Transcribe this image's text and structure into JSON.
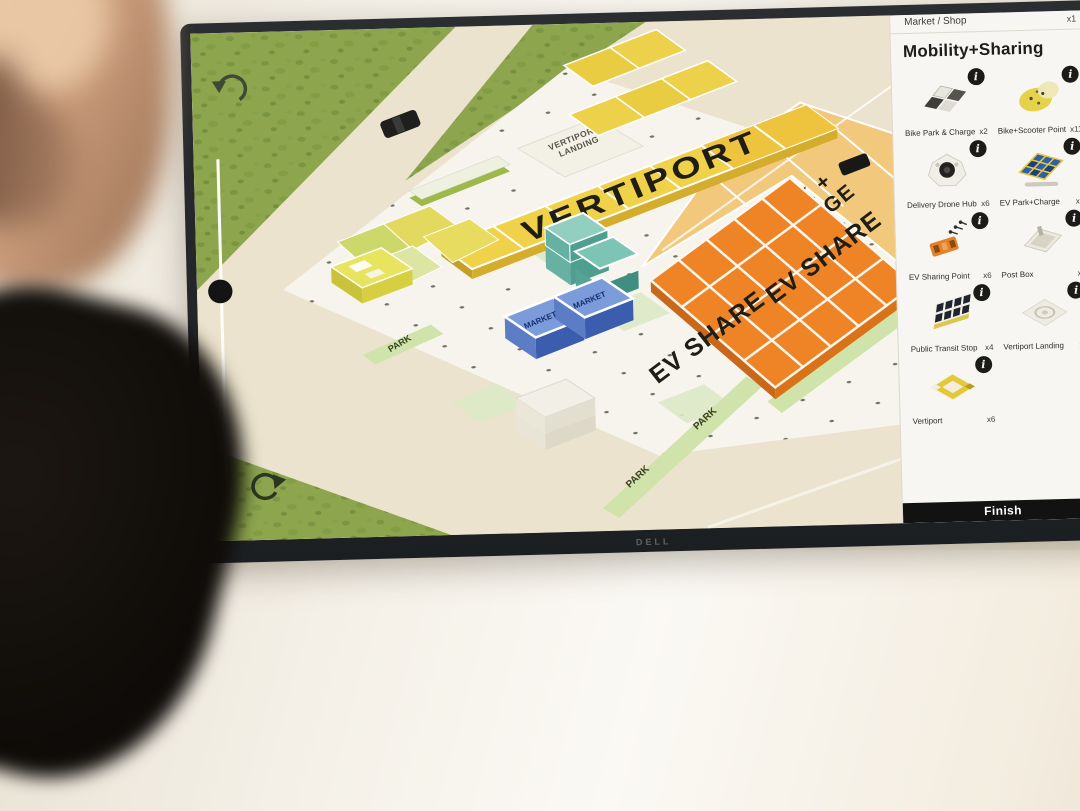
{
  "monitor": {
    "brand": "DELL"
  },
  "map": {
    "labels": {
      "vertiport": "VERTIPORT",
      "vertiport_landing_line1": "VERTIPORT",
      "vertiport_landing_line2": "LANDING",
      "park_charge_line1": "PARK +",
      "park_charge_line2": "CHARGE",
      "ev_share": "EV SHARE",
      "market": "MARKET",
      "park": "PARK"
    }
  },
  "sidebar": {
    "previous_item": {
      "label": "Market / Shop",
      "count": "x1"
    },
    "title": "Mobility+Sharing",
    "info_badge": "i",
    "items": [
      {
        "label": "Bike Park & Charge",
        "count": "x2",
        "icon": "bike-park-charge-icon"
      },
      {
        "label": "Bike+Scooter Point",
        "count": "x11",
        "icon": "bike-scooter-point-icon"
      },
      {
        "label": "Delivery Drone Hub",
        "count": "x6",
        "icon": "delivery-drone-hub-icon"
      },
      {
        "label": "EV Park+Charge",
        "count": "x5",
        "icon": "ev-park-charge-icon"
      },
      {
        "label": "EV Sharing Point",
        "count": "x6",
        "icon": "ev-sharing-point-icon"
      },
      {
        "label": "Post Box",
        "count": "x2",
        "icon": "post-box-icon"
      },
      {
        "label": "Public Transit Stop",
        "count": "x4",
        "icon": "public-transit-stop-icon"
      },
      {
        "label": "Vertiport Landing",
        "count": "x6",
        "icon": "vertiport-landing-icon"
      },
      {
        "label": "Vertiport",
        "count": "x6",
        "icon": "vertiport-icon"
      }
    ],
    "finish_button": "Finish"
  },
  "colors": {
    "grass": "#8da64e",
    "ground": "#ebe3cd",
    "platform": "#f6f4ec",
    "vertiport_yellow": "#f0d24a",
    "ev_orange": "#ef8427",
    "park_charge_tan": "#f2c97c",
    "market_blue": "#7b9bdb",
    "teal": "#8fd0c0",
    "park_strip": "#cfe3ab",
    "finish_bg": "#121212"
  }
}
